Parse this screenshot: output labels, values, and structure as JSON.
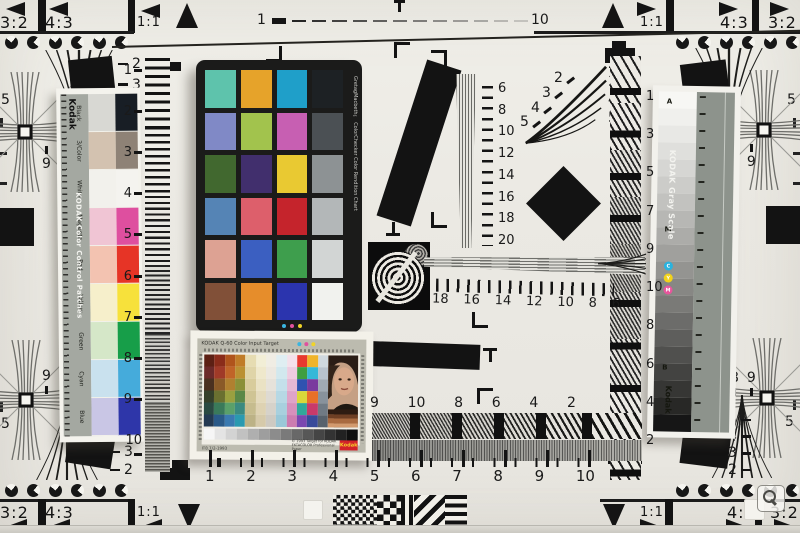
{
  "corner_markers": {
    "top_left": {
      "ratios": [
        "3:2",
        "4:3",
        "1:1"
      ]
    },
    "top_right": {
      "ratios": [
        "1:1",
        "4:3",
        "3:2"
      ]
    },
    "bottom_left": {
      "ratios": [
        "3:2",
        "4:3",
        "1:1"
      ]
    },
    "bottom_right": {
      "ratios": [
        "1:1",
        "4:3",
        "3:2"
      ]
    }
  },
  "top_scale": {
    "start_label": "1",
    "end_label": "10"
  },
  "edge_labels": {
    "left_top": "5",
    "left_bottom": "5",
    "right_top": "5",
    "right_bottom": "5"
  },
  "cross_digits": {
    "top_left": [
      "9",
      "8"
    ],
    "top_right": [
      "8",
      "9"
    ],
    "bottom_left": [
      "9",
      "8"
    ],
    "bottom_right": [
      "8",
      "9"
    ]
  },
  "fans": {
    "top_left": [
      "2",
      "3",
      "4",
      "5"
    ],
    "bottom_left": [
      "5",
      "4",
      "3",
      "2"
    ],
    "top_right": [
      "2",
      "3",
      "4",
      "5"
    ],
    "bottom_right": [
      "5",
      "4",
      "3",
      "2"
    ],
    "center_diagonal": [
      "2",
      "3",
      "4",
      "5"
    ]
  },
  "wedges": {
    "left_vertical": [
      "1",
      "2",
      "3",
      "4",
      "5",
      "6",
      "7",
      "8",
      "9",
      "10"
    ],
    "right_vertical": [
      "1",
      "3",
      "5",
      "7",
      "9",
      "10",
      "8",
      "6",
      "4",
      "2"
    ],
    "center_vertical": [
      "6",
      "8",
      "10",
      "12",
      "14",
      "16",
      "18",
      "20"
    ],
    "center_horizontal": [
      "18",
      "16",
      "14",
      "12",
      "10",
      "8",
      "6"
    ],
    "bottom_horizontal": [
      "9",
      "10",
      "8",
      "6",
      "4",
      "2"
    ],
    "bottom_ruler": [
      "1",
      "2",
      "3",
      "4",
      "5",
      "6",
      "7",
      "8",
      "9",
      "10"
    ]
  },
  "kodak_strip": {
    "brand": "Kodak",
    "title": "KODAK Color Control Patches",
    "rows": [
      {
        "label": "Black",
        "muted": "#d8d8d3",
        "vivid": "#181e25"
      },
      {
        "label": "3/Color",
        "muted": "#d3c2b0",
        "vivid": "#8e8276"
      },
      {
        "label": "White",
        "muted": "#f2f1ec",
        "vivid": "#f4f3ef"
      },
      {
        "label": "Magenta",
        "muted": "#f0c5d4",
        "vivid": "#de4f9f"
      },
      {
        "label": "Red",
        "muted": "#f3c3b1",
        "vivid": "#e63426"
      },
      {
        "label": "Yellow",
        "muted": "#f6efcb",
        "vivid": "#f7e13b"
      },
      {
        "label": "Green",
        "muted": "#d5e7c8",
        "vivid": "#179e49"
      },
      {
        "label": "Cyan",
        "muted": "#c9e1ee",
        "vivid": "#45abdb"
      },
      {
        "label": "Blue",
        "muted": "#c9c6e5",
        "vivid": "#2e36a9"
      }
    ]
  },
  "colorchecker": {
    "title": "GretagMacbeth™ ColorChecker Color Rendition Chart",
    "rows": [
      [
        "#5ec3ac",
        "#e6a32a",
        "#1f9fc9",
        "#1d2124"
      ],
      [
        "#8089c6",
        "#a2c34d",
        "#c75fb2",
        "#4b5054"
      ],
      [
        "#41682f",
        "#412f6d",
        "#e9c932",
        "#8d9294"
      ],
      [
        "#5584b5",
        "#dd5f6b",
        "#c5242c",
        "#b3b7b8"
      ],
      [
        "#dda293",
        "#3b5fc1",
        "#3e9e4d",
        "#d2d5d4"
      ],
      [
        "#815038",
        "#e68d2b",
        "#2b34ae",
        "#f1f2ee"
      ]
    ]
  },
  "grayscale_strip": {
    "title": "KODAK Gray Scale",
    "brand": "Kodak",
    "markers": {
      "top": "A",
      "middle": "M",
      "lower": "B"
    },
    "dots": [
      {
        "label": "C",
        "color": "#2ab3de"
      },
      {
        "label": "Y",
        "color": "#f2d219"
      },
      {
        "label": "M",
        "color": "#e8559c"
      }
    ],
    "steps": [
      "#f7f7f4",
      "#f0f0ed",
      "#e8e8e5",
      "#dfdfdc",
      "#d6d6d3",
      "#ccccc9",
      "#c2c2bf",
      "#b7b7b4",
      "#acaca9",
      "#a0a09d",
      "#949491",
      "#878784",
      "#7a7a77",
      "#6c6c6a",
      "#5e5e5c",
      "#50504e",
      "#434341",
      "#363634",
      "#282826",
      "#161616"
    ]
  },
  "it8": {
    "header": "KODAK Q-60 Color Input Target",
    "footer_left": "IT8.7/2-1993",
    "footer_right": "© 1993 Target for KODAK EKTACOLOR Professional Paper",
    "brand": "Kodak",
    "grid": [
      [
        "#5c2014",
        "#8a2c1a",
        "#b0541c",
        "#c07c28",
        "#e6dcb2",
        "#f2eed6",
        "#f0ede4",
        "#dfeef2",
        "#f4e0ea",
        "#e8392f",
        "#f0b42a",
        "#cfd8de"
      ],
      [
        "#6b2a2a",
        "#a03a28",
        "#c06428",
        "#ba9032",
        "#dfd4a8",
        "#efe8cc",
        "#ece8e0",
        "#d2e8ee",
        "#eecce0",
        "#3f9e42",
        "#35b8d8",
        "#b8c2cc"
      ],
      [
        "#4a3020",
        "#8a5a28",
        "#b08030",
        "#8a9038",
        "#d8cc9c",
        "#eae2c4",
        "#e6e2da",
        "#c4e0ea",
        "#e6b8d4",
        "#2f52b0",
        "#7a3a9e",
        "#a0aab4"
      ],
      [
        "#35402a",
        "#6a7030",
        "#9aa040",
        "#5a8848",
        "#cfc494",
        "#e4dabc",
        "#dedad2",
        "#b6d8e4",
        "#dea4c8",
        "#d8d83a",
        "#e87028",
        "#88929c"
      ],
      [
        "#2a4a42",
        "#3a7a5a",
        "#5aa06a",
        "#3a8a80",
        "#c6bc8e",
        "#ded2b2",
        "#d6d2ca",
        "#a8d0de",
        "#d690bc",
        "#30a89a",
        "#c83a6a",
        "#707a84"
      ],
      [
        "#243a52",
        "#2a5a88",
        "#3a7ab0",
        "#2a9ab0",
        "#bcb286",
        "#d6caaa",
        "#cecac2",
        "#9ac8d8",
        "#cc7cb0",
        "#7a48b0",
        "#384a9a",
        "#58626c"
      ]
    ],
    "skin_bars": [
      "#2e1c12",
      "#6e3f24",
      "#a86a40",
      "#d29a6e"
    ]
  },
  "magnifier": {
    "action": "zoom"
  }
}
